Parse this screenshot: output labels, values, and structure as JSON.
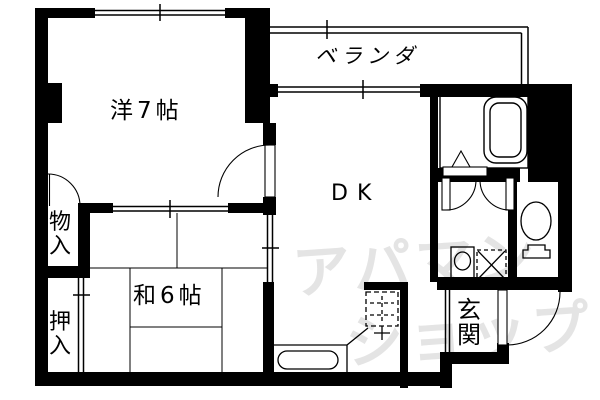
{
  "plan": {
    "title": "apartment-floor-plan",
    "rooms": {
      "western": {
        "label": "洋7帖"
      },
      "dk": {
        "label": "DK"
      },
      "japanese": {
        "label": "和6帖"
      },
      "veranda": {
        "label": "ベランダ"
      },
      "storage": {
        "label": "物\n入"
      },
      "closet": {
        "label": "押\n入"
      },
      "entrance": {
        "label": "玄\n関"
      }
    },
    "fixtures": [
      "bathtub",
      "toilet",
      "washbasin",
      "washing-machine",
      "gas-stove",
      "kitchen-sink",
      "tatami-6"
    ],
    "colors": {
      "wall": "#000000",
      "background": "#ffffff",
      "watermark": "#e4e4e4"
    }
  },
  "watermark": {
    "line1": "アパマン",
    "line2": "ショップ"
  }
}
